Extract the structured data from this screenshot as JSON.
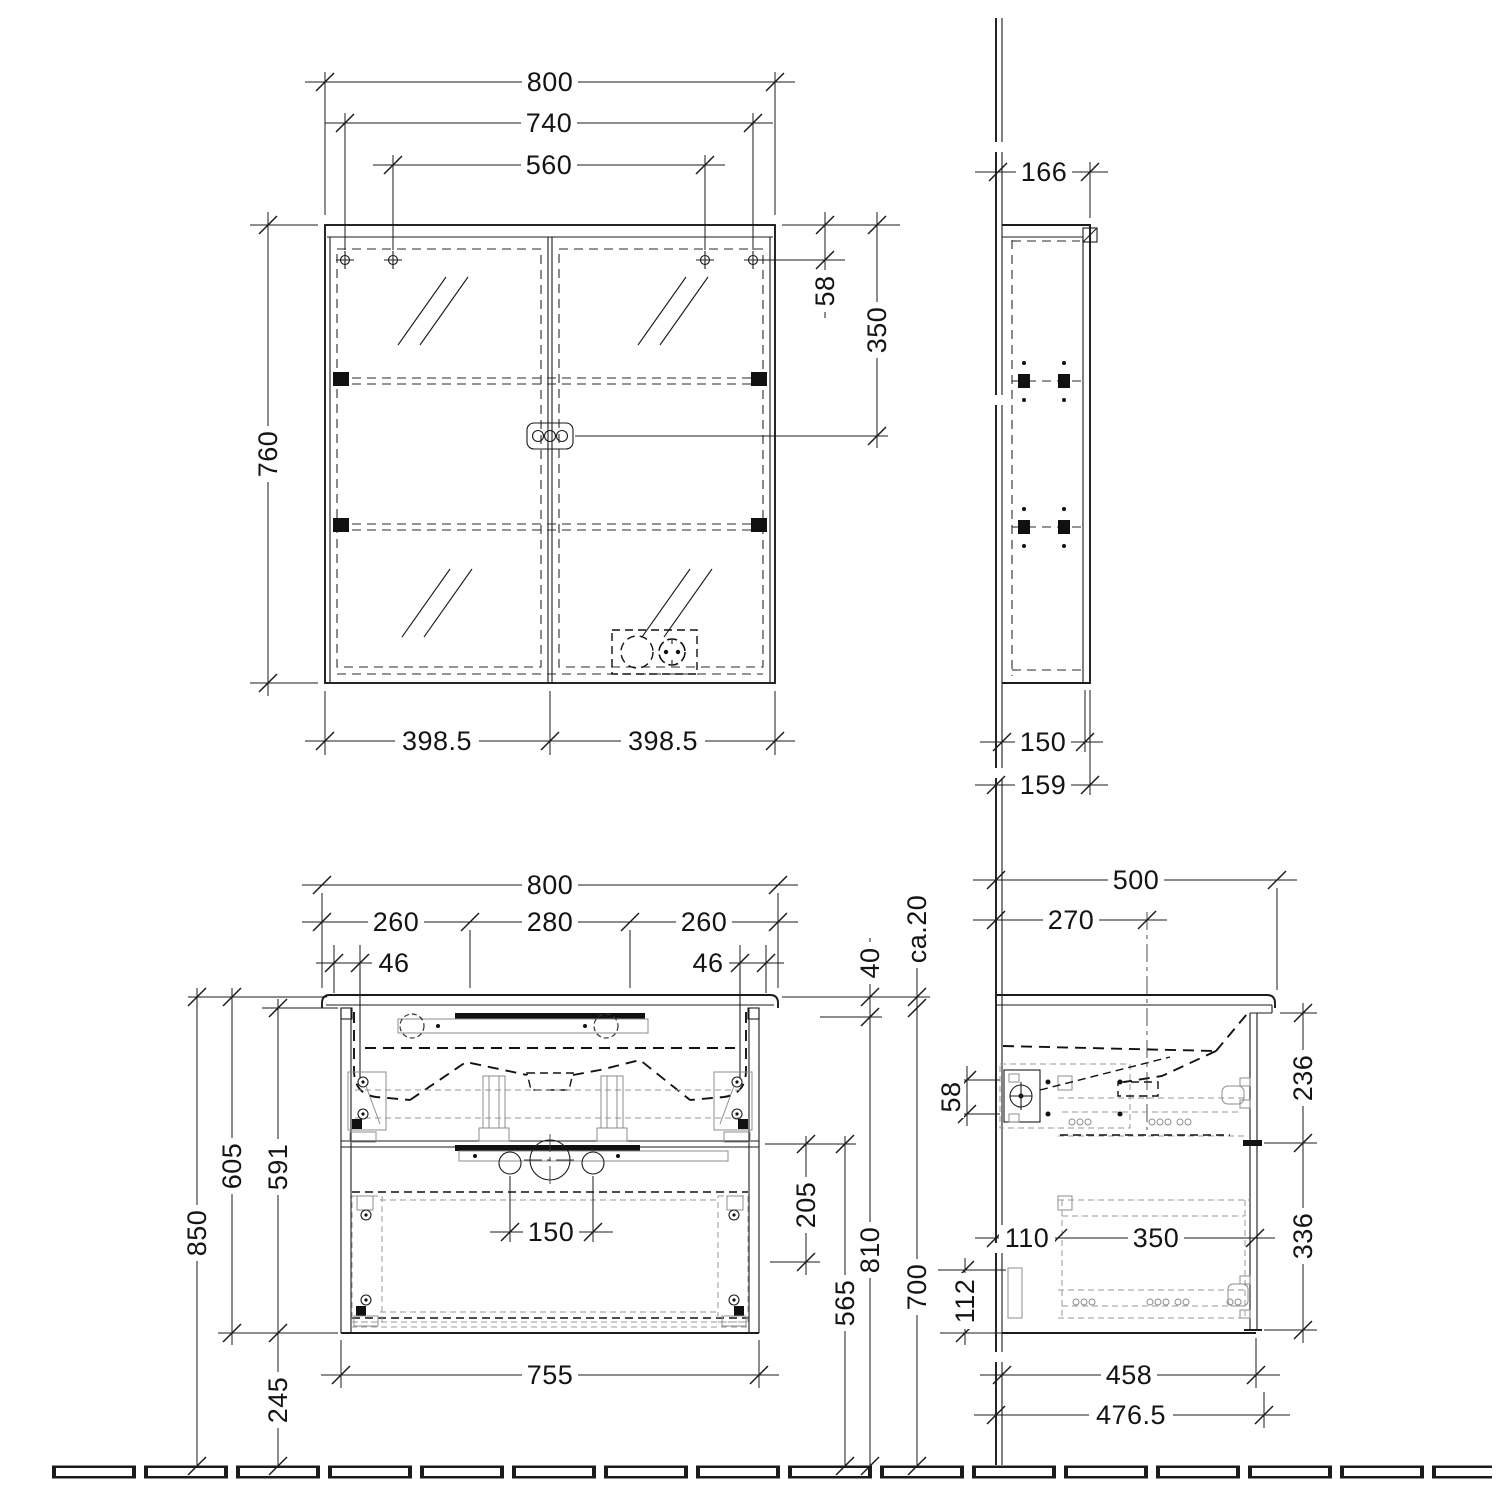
{
  "views": {
    "mirror_front": {
      "dims": {
        "width": "800",
        "mount_width": "740",
        "mount_inner_width": "560",
        "height": "760",
        "mount_top_offset": "58",
        "socket_top_offset": "350",
        "door_left": "398.5",
        "door_right": "398.5"
      }
    },
    "mirror_side": {
      "dims": {
        "depth": "166",
        "body_depth": "150",
        "total_depth": "159"
      }
    },
    "vanity_front": {
      "dims": {
        "width": "800",
        "span_left": "260",
        "span_center": "280",
        "span_right": "260",
        "inset_left": "46",
        "inset_right": "46",
        "basin_height": "40",
        "basin_overhang": "ca.20",
        "bracket_offset": "58",
        "total_height": "850",
        "basin_to_bottom": "605",
        "cabinet_height": "591",
        "floor_clearance": "245",
        "drain_spacing": "150",
        "drawer_clearance": "205",
        "split_height": "565",
        "underside_height": "810",
        "trap_height": "700",
        "cabinet_width": "755"
      }
    },
    "vanity_side": {
      "dims": {
        "depth": "500",
        "drain_offset": "270",
        "top_drawer_front": "236",
        "bottom_drawer_front": "336",
        "rail_offset": "110",
        "rail_length": "350",
        "siphon_offset": "112",
        "cabinet_depth": "458",
        "total_depth": "476.5"
      }
    }
  }
}
